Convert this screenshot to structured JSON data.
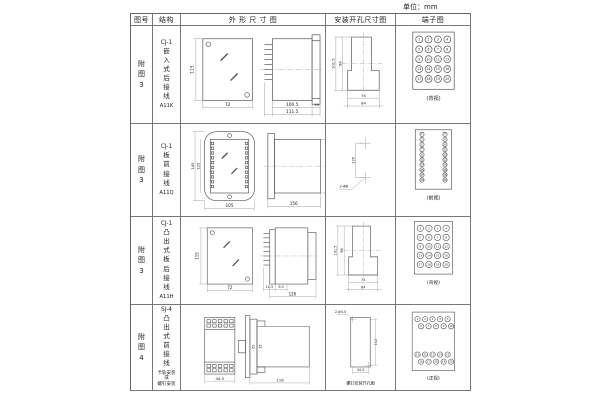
{
  "unit_label": "单位：mm",
  "table": {
    "headers": {
      "fig": "图号",
      "structure": "结构",
      "outline": "外 形 尺 寸 图",
      "mounting": "安装开孔尺寸图",
      "terminal": "端子图"
    },
    "rows": [
      {
        "fig": "附图3",
        "model": "CJ-1",
        "structure": "嵌入式后接线",
        "code": "A11K",
        "outline": {
          "front_h": "115",
          "front_w": "72",
          "depth": "100.5",
          "total_depth": "111.5",
          "flange": "16"
        },
        "mounting": {
          "v_outer": "101.5",
          "v_inner": "98",
          "h_inner": "74",
          "h_outer": "84"
        },
        "terminal": {
          "caption": "(背视)",
          "numbers": [
            1,
            2,
            3,
            4,
            5,
            6,
            7,
            8,
            9,
            10,
            11,
            12,
            13,
            14,
            15,
            16,
            17,
            18,
            19,
            20
          ]
        }
      },
      {
        "fig": "附图3",
        "model": "CJ-1",
        "structure": "板前接线",
        "code": "A11Q",
        "outline": {
          "front_h": "145",
          "inner_h": "125",
          "front_w": "105",
          "depth": "156",
          "side_h": "121"
        },
        "mounting": {
          "v": "135",
          "holes": "2-Φ6"
        },
        "terminal": {
          "caption": "(前视)",
          "numbers": [
            1,
            3,
            5,
            7,
            9,
            11,
            13,
            15,
            17,
            19,
            2,
            4,
            6,
            8,
            10,
            12,
            14,
            16,
            18,
            20
          ]
        }
      },
      {
        "fig": "附图3",
        "model": "CJ-1",
        "structure": "凸出式板后接线",
        "code": "A11H",
        "outline": {
          "front_h": "115",
          "front_w": "72",
          "d1": "11.5",
          "d2": "9.5",
          "depth": "126"
        },
        "mounting": {
          "v_outer": "101.5",
          "v_inner": "98",
          "h_inner": "74",
          "h_outer": "84"
        },
        "terminal": {
          "caption": "(背视)",
          "numbers": [
            1,
            2,
            3,
            4,
            5,
            6,
            7,
            8,
            9,
            10,
            11,
            12,
            13,
            14,
            15,
            16,
            17,
            18,
            19,
            20
          ]
        }
      },
      {
        "fig": "附图4",
        "model": "SJ-4",
        "structure": "凸出式前接线",
        "note_lines": [
          "卡轨安装",
          "或",
          "螺钉安装"
        ],
        "outline": {
          "front_w": "44.5",
          "clip_h1": "65",
          "clip_h2": "35",
          "depth": "118"
        },
        "mounting": {
          "holes": "2-Φ4.5",
          "v": "112",
          "h": "44.5",
          "caption": "螺钉安装开孔图"
        },
        "terminal": {
          "caption": "(正视)",
          "numbers": [
            1,
            2,
            3,
            4,
            5,
            6,
            7,
            8,
            9,
            10,
            11,
            12,
            13,
            14,
            15,
            16,
            17,
            18,
            19,
            20
          ]
        }
      }
    ]
  }
}
